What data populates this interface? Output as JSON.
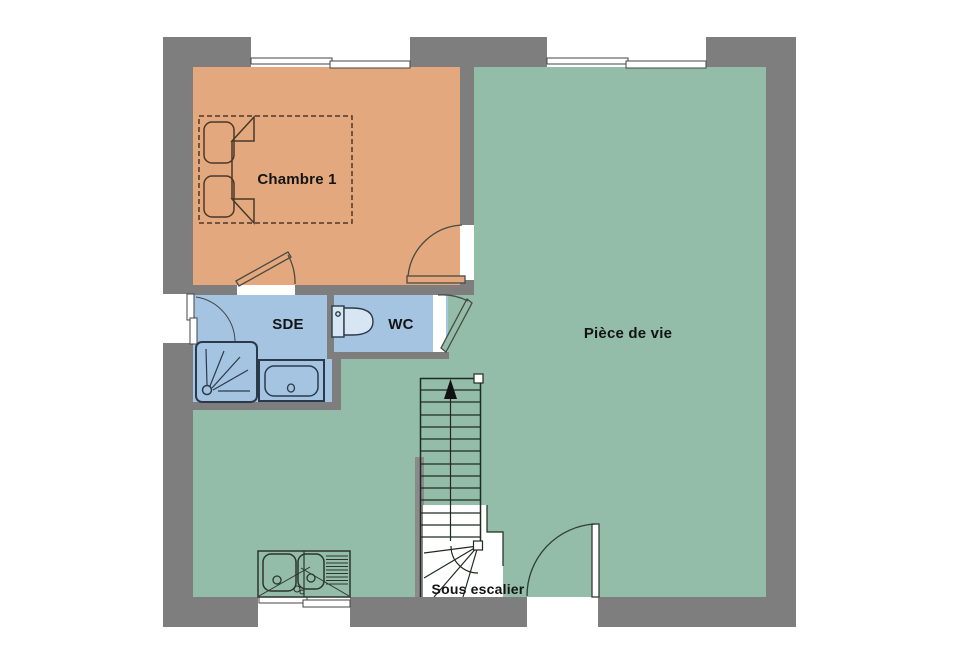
{
  "plan": {
    "type": "floor-plan",
    "rooms": {
      "chambre1": {
        "label": "Chambre 1",
        "fill": "#E3A87D"
      },
      "sde": {
        "label": "SDE",
        "fill": "#A4C4E1"
      },
      "wc": {
        "label": "WC",
        "fill": "#A4C4E1"
      },
      "piece_de_vie": {
        "label": "Pièce de vie",
        "fill": "#93BCA9"
      }
    },
    "annotations": {
      "sous_escalier": "Sous escalier"
    },
    "colors": {
      "wall": "#7E7E7E",
      "background": "#FFFFFF",
      "bedroom_fill": "#E3A87D",
      "living_fill": "#93BCA9",
      "bathroom_fill": "#A4C4E1",
      "line_dark": "#30352f"
    },
    "fixtures": [
      "double-bed",
      "shower",
      "bathtub",
      "toilet",
      "kitchen-sink",
      "staircase"
    ],
    "openings": [
      "window-top-left",
      "window-top-right",
      "window-left",
      "window-bottom",
      "entrance-door",
      "bedroom-door",
      "shower-room-door",
      "wc-door"
    ]
  }
}
